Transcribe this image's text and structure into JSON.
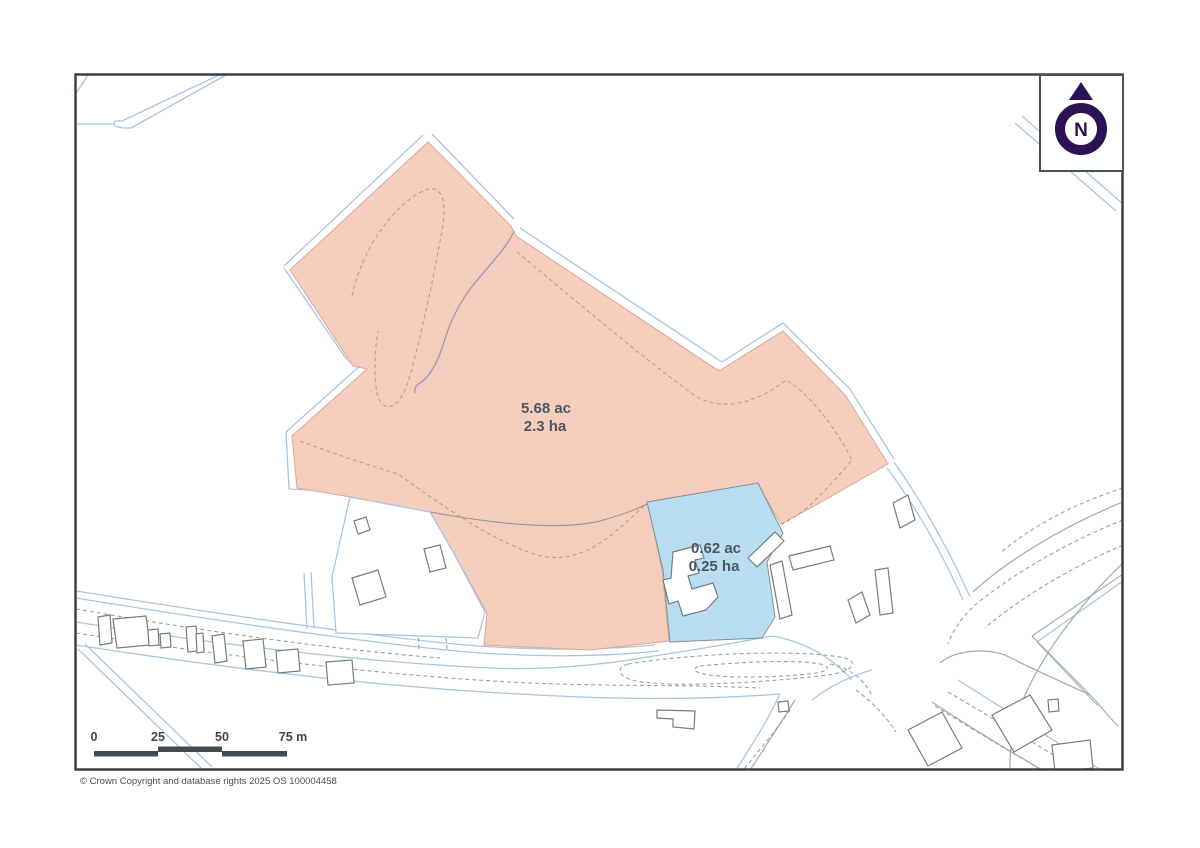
{
  "map": {
    "parcels": [
      {
        "id": "main-parcel",
        "area_acres": "5.68 ac",
        "area_hectares": "2.3 ha",
        "fill": "#f6cebe"
      },
      {
        "id": "secondary-parcel",
        "area_acres": "0.62 ac",
        "area_hectares": "0.25 ha",
        "fill": "#b9def2"
      }
    ],
    "north_indicator": {
      "letter": "N",
      "color": "#2d1155"
    },
    "scale_bar": {
      "ticks": [
        "0",
        "25",
        "50",
        "75 m"
      ],
      "bar_color": "#434c52"
    },
    "attribution": "© Crown Copyright and database rights 2025 OS 100004458",
    "colors": {
      "frame": "#3b4145",
      "road_line": "#a9c6e0",
      "field_dash": "#cf9484",
      "building_outline": "#757c82"
    }
  }
}
